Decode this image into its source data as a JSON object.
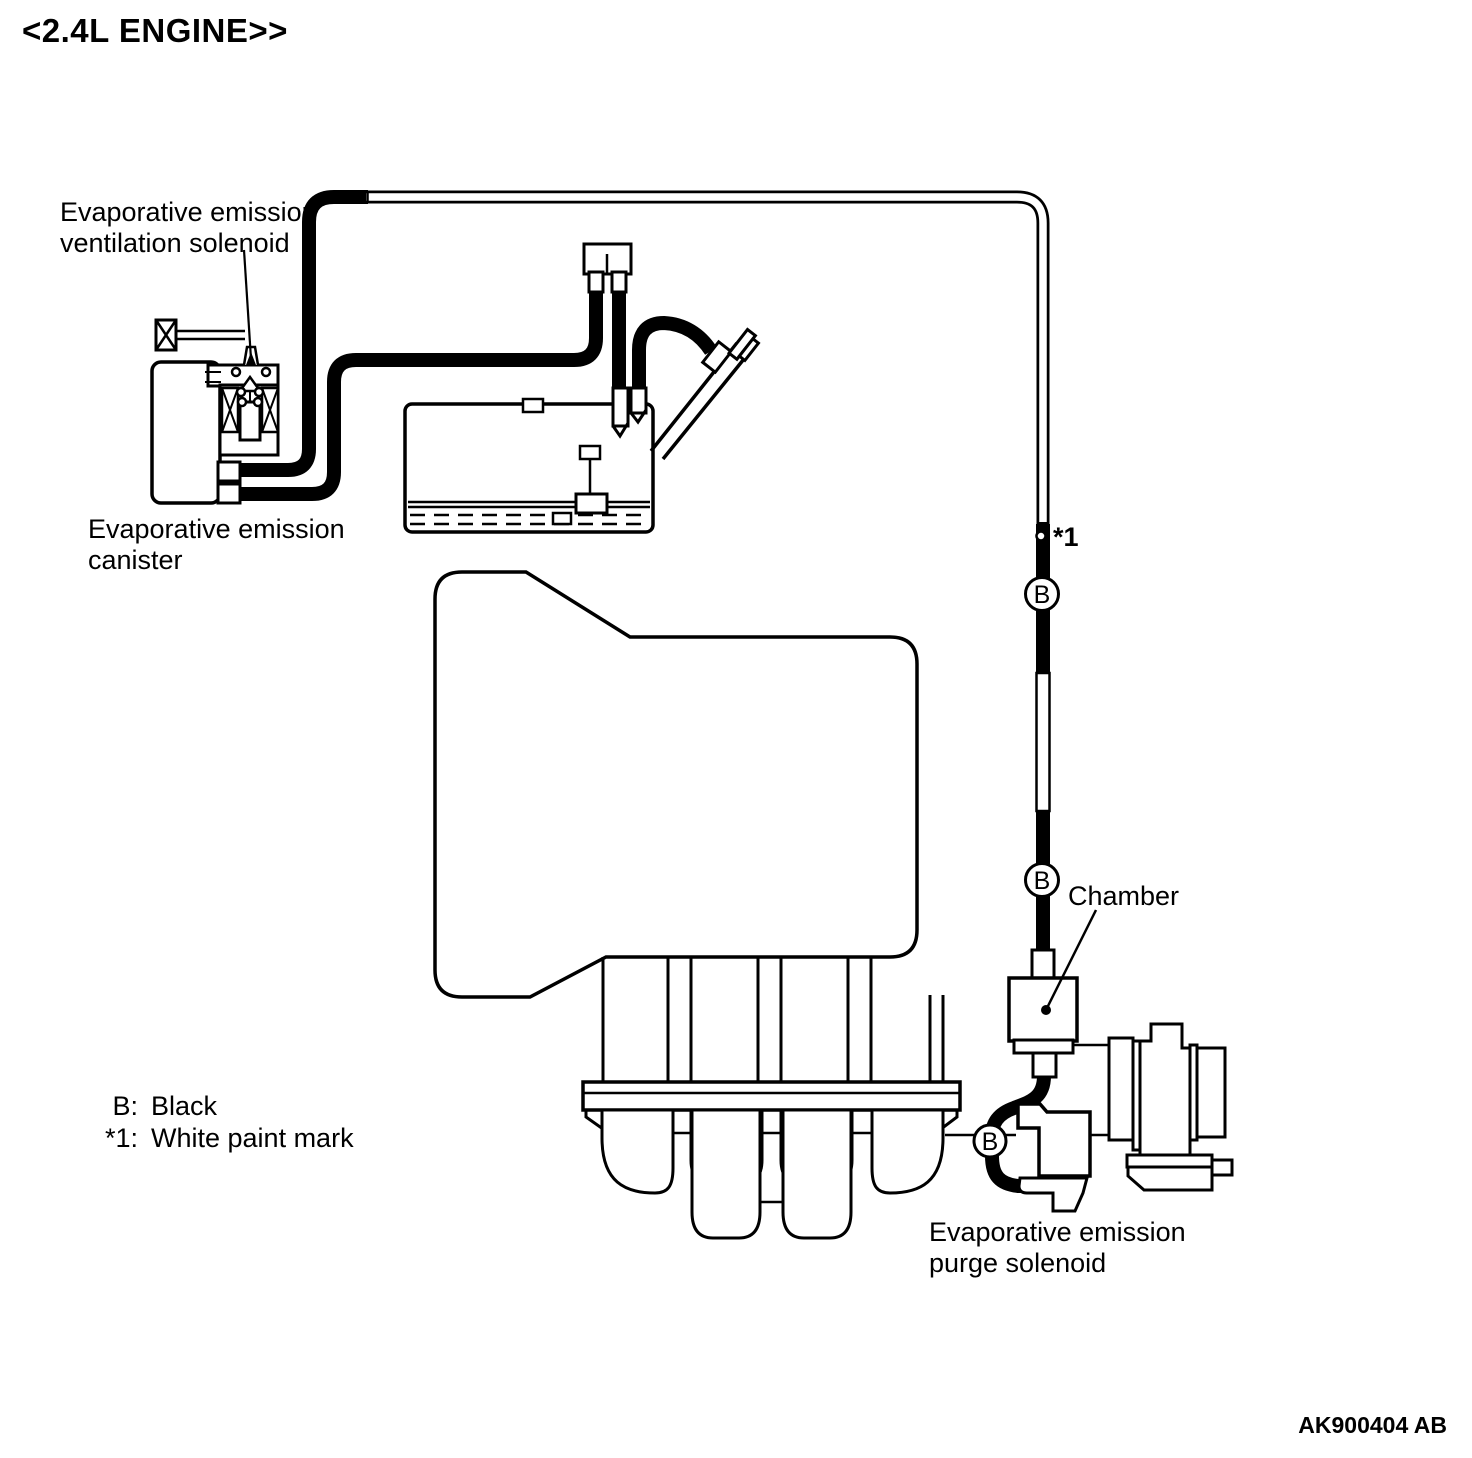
{
  "title": "<2.4L ENGINE>>",
  "part_number": "AK900404 AB",
  "labels": {
    "ventilation_solenoid_line1": "Evaporative emission",
    "ventilation_solenoid_line2": "ventilation solenoid",
    "canister_line1": "Evaporative emission",
    "canister_line2": "canister",
    "chamber": "Chamber",
    "purge_solenoid_line1": "Evaporative emission",
    "purge_solenoid_line2": "purge solenoid"
  },
  "markers": {
    "color_code": "B",
    "paint_mark": "*1"
  },
  "legend": {
    "rows": [
      {
        "key": "B:",
        "value": "Black"
      },
      {
        "key": "*1:",
        "value": "White paint mark"
      }
    ]
  },
  "colors": {
    "line": "#000000",
    "background": "#ffffff"
  }
}
